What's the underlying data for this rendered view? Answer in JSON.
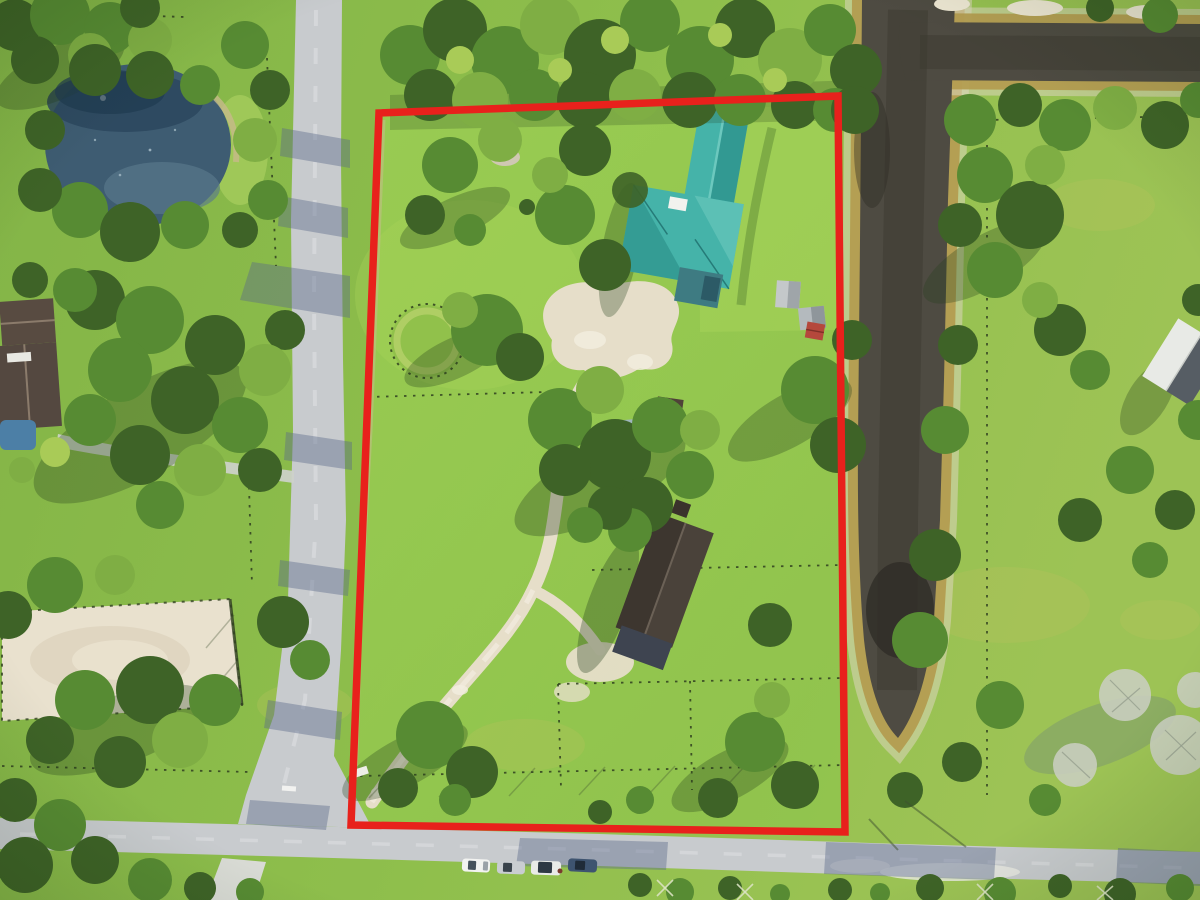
{
  "meta": {
    "type": "aerial-photograph",
    "description": "Drone aerial photo of an equestrian property outlined with a red lot boundary, flanked by a pond and road on the west, a drainage canal on the east, and a frontage road with parked cars at the south"
  },
  "palette": {
    "boundary_red": "#E8211C",
    "grass_left": "#86B649",
    "grass_mid": "#8FBF4C",
    "grass_right": "#9DC355",
    "lawn_property": "#9CCD53",
    "lawn_highlight": "#A8D55A",
    "canopy_dark": "#3E6327",
    "canopy_mid": "#578B33",
    "canopy_light": "#7FAE44",
    "canopy_accent": "#A9CB57",
    "ground_shadow": "#243E1C",
    "road_gray": "#C8CBCE",
    "road_light": "#E2E4E6",
    "road_shadow_blue": "#5A6A8A",
    "pond_water": "#3E5C72",
    "pond_water_dark": "#2B475E",
    "canal_water": "#4E4B42",
    "canal_bank_gold": "#B29A4C",
    "bank_sand_pale": "#DCD5BD",
    "arena_sand": "#E9E1CE",
    "track_sand": "#E6DEC9",
    "sand_white": "#F2EDE0",
    "roof_teal": "#45B3A9",
    "roof_teal_dark": "#2F948E",
    "roof_teal_light": "#6CC8BE",
    "barn_roof": "#4A423A",
    "barn_annex": "#3E4450",
    "west_house_roof": "#584B41",
    "cabin_roof": "#4F4238",
    "trailer_gray_blue": "#9FB6BC",
    "shed_gray": "#C4C8CA",
    "shed_red": "#B5483C",
    "east_building_white": "#E8EAE6",
    "east_building_roof": "#565D64",
    "car_white": "#F2F3F1",
    "car_silver": "#C9CDD1",
    "car_pale": "#E9EBE8",
    "car_dark": "#3E5470",
    "pool_blue": "#4C7FA6",
    "fence_dark": "#2F3E20",
    "dead_tree": "#C9CEC0"
  },
  "scene": {
    "features": [
      {
        "name": "property-boundary",
        "note": "red outline around the listed lot"
      },
      {
        "name": "main-house",
        "note": "teal metal hip roof house with white roof patch"
      },
      {
        "name": "barn",
        "note": "dark brown gable barn with annex"
      },
      {
        "name": "round-pen",
        "note": "circular fenced pen"
      },
      {
        "name": "riding-arena",
        "note": "sand arena on neighboring parcel"
      },
      {
        "name": "pond",
        "note": "neighbor pond, northwest"
      },
      {
        "name": "canal",
        "note": "L-shaped drainage canal, east and northeast"
      },
      {
        "name": "diagonal-road",
        "note": "paved road along west side"
      },
      {
        "name": "frontage-road",
        "note": "paved road along south side"
      },
      {
        "name": "parked-cars",
        "count": 4,
        "colors": [
          "white",
          "silver",
          "white",
          "dark-blue"
        ]
      },
      {
        "name": "sheds",
        "count": 3
      },
      {
        "name": "neighbor-house-west"
      },
      {
        "name": "east-building"
      },
      {
        "name": "driveway-track",
        "note": "sand drive from south gate to house and barn"
      }
    ]
  }
}
